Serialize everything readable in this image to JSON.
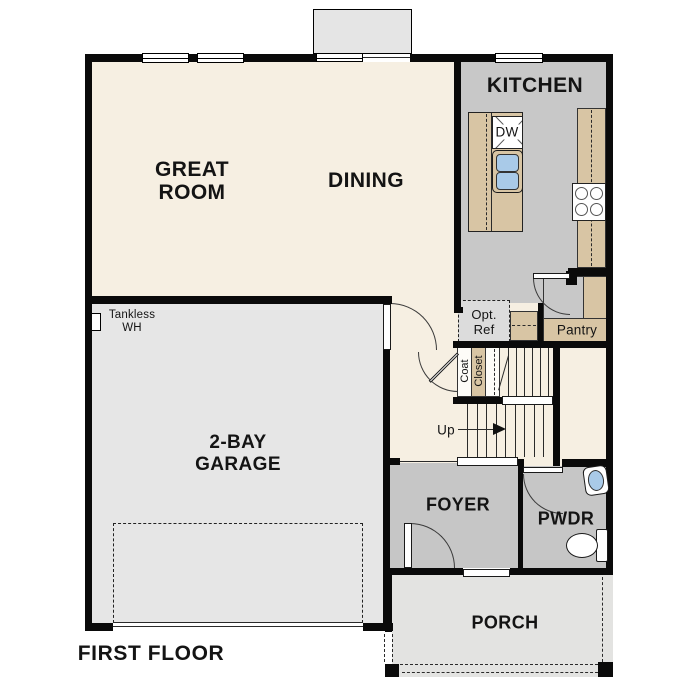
{
  "plan": {
    "title": "FIRST FLOOR",
    "rooms": {
      "great_room": {
        "line1": "GREAT",
        "line2": "ROOM"
      },
      "dining": {
        "label": "DINING"
      },
      "kitchen": {
        "label": "KITCHEN"
      },
      "garage": {
        "line1": "2-BAY",
        "line2": "GARAGE"
      },
      "foyer": {
        "label": "FOYER"
      },
      "powder_room": {
        "label": "PWDR"
      },
      "porch": {
        "label": "PORCH"
      },
      "pantry": {
        "label": "Pantry"
      }
    },
    "annotations": {
      "coat_closet": {
        "line1": "Coat",
        "line2": "Closet"
      },
      "opt_ref": {
        "line1": "Opt.",
        "line2": "Ref"
      },
      "tankless_wh": {
        "line1": "Tankless",
        "line2": "WH"
      },
      "stairs_up": {
        "label": "Up"
      },
      "dishwasher": {
        "label": "DW"
      }
    },
    "colors": {
      "room_cream": "#f6efe2",
      "floor_gray": "#c8c8c8",
      "garage_gray": "#e6e6e6",
      "porch_gray": "#e3e3e1",
      "cabinet_tan": "#d8c5a4",
      "sink_blue": "#a9cae8",
      "wall_black": "#0a0a0a"
    }
  }
}
